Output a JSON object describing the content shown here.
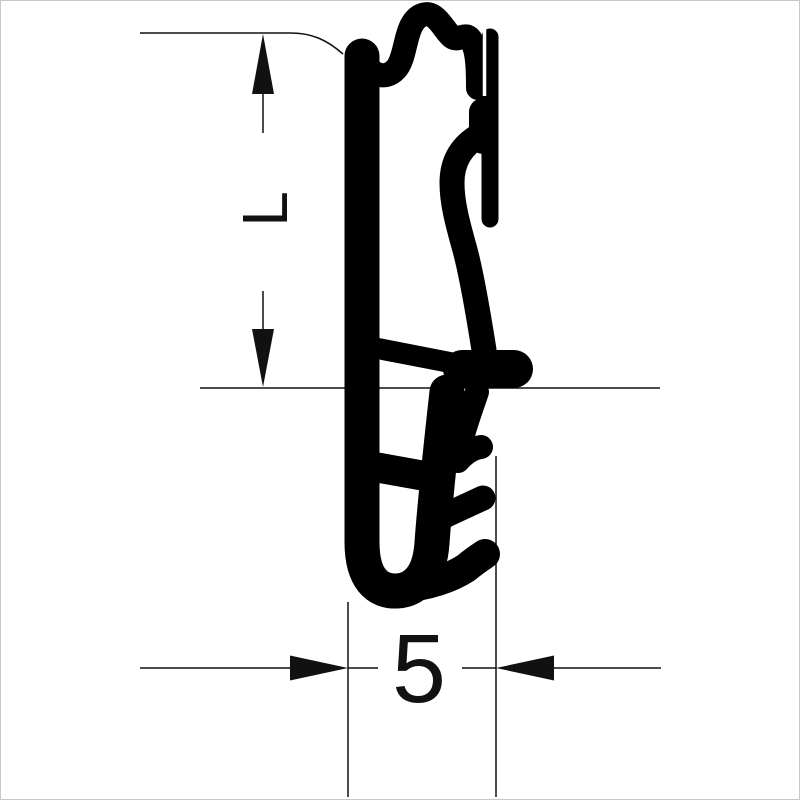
{
  "drawing": {
    "kind": "seal-profile-cross-section",
    "dimensions": {
      "height": {
        "label": "L"
      },
      "width": {
        "label": "5"
      }
    },
    "colors": {
      "profile": "#000000",
      "ink": "#111111",
      "background": "#ffffff",
      "frame_border": "#c8c8c8"
    }
  }
}
